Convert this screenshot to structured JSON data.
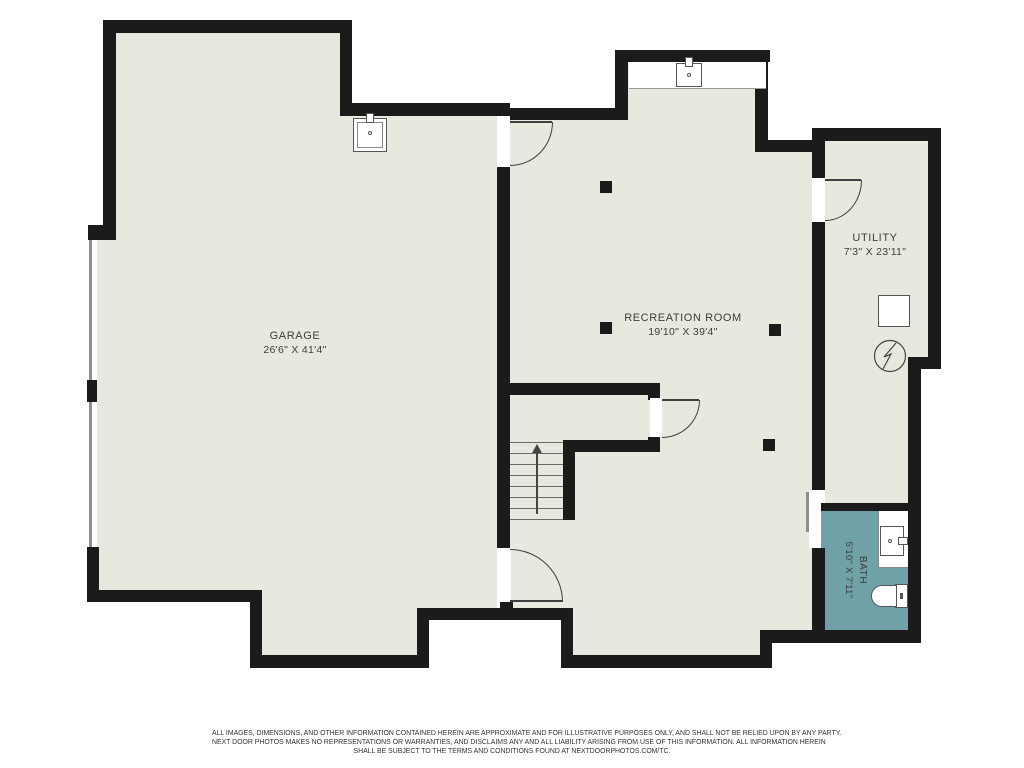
{
  "colors": {
    "background": "#ffffff",
    "floor": "#e9e8df",
    "wall": "#1b1b1b",
    "bath_floor": "#6fa1a7",
    "window_line": "#8f8f8f",
    "label_text": "#3c3c3c",
    "fixture_line": "#555555",
    "disclaimer_text": "#333333"
  },
  "rooms": {
    "garage": {
      "label": "GARAGE",
      "dims": "26'6\" X 41'4\""
    },
    "recreation_room": {
      "label": "RECREATION ROOM",
      "dims": "19'10\" X 39'4\""
    },
    "utility": {
      "label": "UTILITY",
      "dims": "7'3\" X 23'11\""
    },
    "bath": {
      "label": "BATH",
      "dims": "5'10\" X 7'11\""
    }
  },
  "stairs": {
    "direction_arrow": "up"
  },
  "symbols": [
    "laundry-sink",
    "garage-sink",
    "furnace",
    "electrical-panel",
    "bath-vanity-sink",
    "toilet",
    "stairs-up-arrow",
    "structural-posts",
    "windows",
    "door-swings",
    "pocket-door"
  ],
  "disclaimer": {
    "lines": [
      "ALL IMAGES, DIMENSIONS, AND OTHER INFORMATION CONTAINED HEREIN ARE APPROXIMATE AND FOR ILLUSTRATIVE PURPOSES ONLY, AND SHALL NOT BE RELIED UPON BY ANY PARTY.",
      "NEXT DOOR PHOTOS MAKES NO REPRESENTATIONS OR WARRANTIES, AND DISCLAIMS ANY AND ALL LIABILITY ARISING FROM USE OF THIS INFORMATION. ALL INFORMATION HEREIN",
      "SHALL BE SUBJECT TO THE TERMS AND CONDITIONS FOUND AT NEXTDOORPHOTOS.COM/TC."
    ]
  }
}
